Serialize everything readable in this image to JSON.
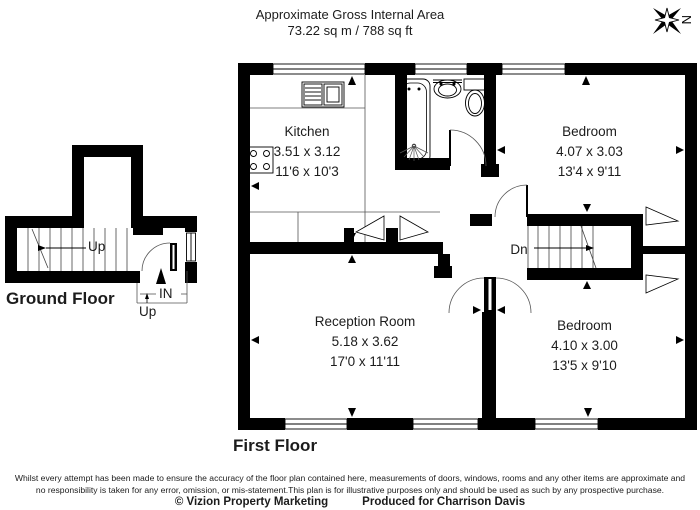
{
  "header": {
    "title": "Approximate Gross Internal Area",
    "area": "73.22 sq m / 788 sq ft"
  },
  "compass": {
    "letter": "N"
  },
  "ground_floor": {
    "label": "Ground Floor",
    "stairs_label": "Up",
    "entrance_label": "IN",
    "entrance_up_label": "Up"
  },
  "first_floor": {
    "label": "First Floor",
    "stairs_label": "Dn",
    "rooms": {
      "kitchen": {
        "name": "Kitchen",
        "metric": "3.51 x 3.12",
        "imperial": "11'6 x 10'3"
      },
      "bedroom1": {
        "name": "Bedroom",
        "metric": "4.07 x 3.03",
        "imperial": "13'4 x 9'11"
      },
      "reception": {
        "name": "Reception Room",
        "metric": "5.18 x 3.62",
        "imperial": "17'0 x 11'11"
      },
      "bedroom2": {
        "name": "Bedroom",
        "metric": "4.10 x 3.00",
        "imperial": "13'5 x 9'10"
      }
    }
  },
  "footer": {
    "line1": "Whilst every attempt has been made to ensure the accuracy of the floor plan contained here, measurements of doors, windows, rooms and any other items are approximate and",
    "line2": "no responsibility is taken for any error, omission, or mis-statement.This plan is for illustrative purposes only and should be used as such by any prospective purchase.",
    "copyright": "© Vizion Property Marketing",
    "produced": "Produced for Charrison Davis"
  },
  "colors": {
    "wall": "#000000",
    "background": "#ffffff"
  }
}
